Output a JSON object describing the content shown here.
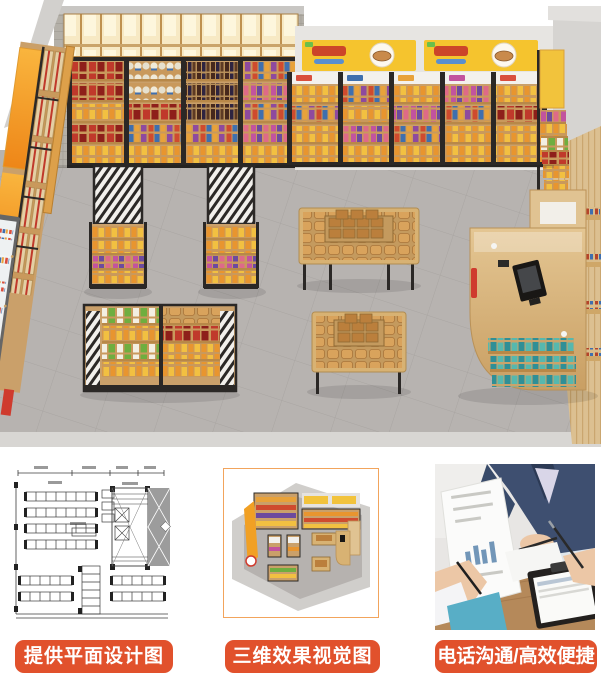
{
  "captions": {
    "plan": "提供平面设计图",
    "render": "三维效果视觉图",
    "contact": "电话沟通/高效便捷"
  },
  "hero": {
    "description": "3D isometric render of a convenience store interior",
    "elements": [
      "wall-shelving-units",
      "lit-display-cabinets",
      "promo-banners",
      "gondola-shelves",
      "bread-display-tables",
      "curved-checkout-counter",
      "drink-cooler",
      "wood-slat-wall",
      "tiled-floor"
    ]
  },
  "thumbnails": [
    {
      "id": "floor-plan",
      "kind": "cad-drawing"
    },
    {
      "id": "3d-view",
      "kind": "mini-render"
    },
    {
      "id": "consultation",
      "kind": "photo"
    }
  ],
  "colors": {
    "accent_orange": "#e1512c",
    "banner_yellow": "#f5c42e",
    "wall_orange": "#f4a01e",
    "wood": "#cfa768",
    "frame_black": "#2b2826",
    "floor_gray": "#b6b2af",
    "thumb_frame_orange": "#f2a45c"
  }
}
